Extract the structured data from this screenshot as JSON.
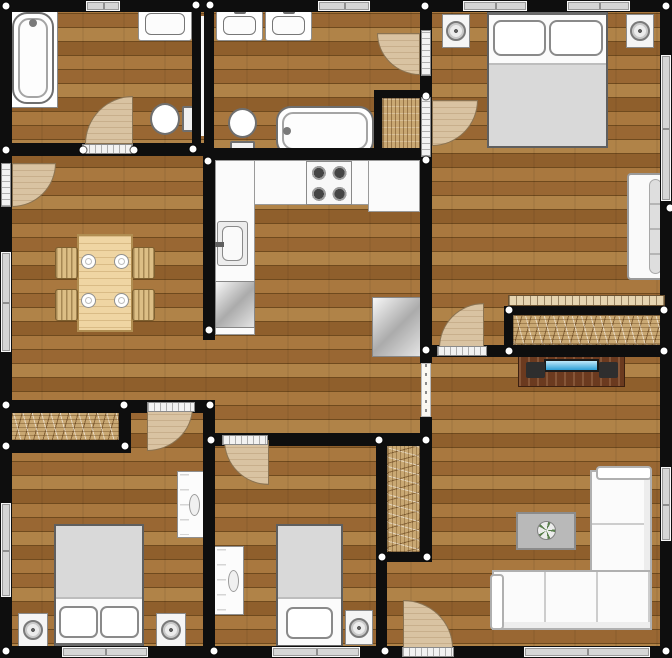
{
  "plan": {
    "width": 672,
    "height": 658
  },
  "colors": {
    "wall": "#0e0e0e",
    "floor_light": "#b08348",
    "floor_mid": "#996733",
    "floor_dark": "#8f5f2c",
    "door_leaf": "#d9c3a2",
    "window_glass": "#d6d6d6",
    "tv_screen": "#2e9fd6",
    "closet_hatch": "#c9a873",
    "bedding_gray": "#d9d9d9"
  },
  "walls": [
    {
      "name": "wall-exterior-top",
      "r": [
        0,
        0,
        672,
        12
      ]
    },
    {
      "name": "wall-exterior-left",
      "r": [
        0,
        0,
        12,
        658
      ]
    },
    {
      "name": "wall-exterior-right",
      "r": [
        660,
        0,
        12,
        658
      ]
    },
    {
      "name": "wall-exterior-bottom",
      "r": [
        0,
        646,
        672,
        12
      ]
    },
    {
      "name": "wall-bathroom1-south",
      "r": [
        0,
        143,
        212,
        13
      ]
    },
    {
      "name": "wall-bathrooms-divider-west",
      "r": [
        192,
        8,
        9,
        140
      ]
    },
    {
      "name": "wall-bathrooms-divider-east",
      "r": [
        204,
        8,
        10,
        140
      ]
    },
    {
      "name": "wall-kitchen-west",
      "r": [
        203,
        148,
        12,
        192
      ]
    },
    {
      "name": "wall-kitchen-north",
      "r": [
        203,
        148,
        229,
        12
      ]
    },
    {
      "name": "wall-spine-upper",
      "r": [
        420,
        12,
        12,
        351
      ]
    },
    {
      "name": "wall-spine-lower",
      "r": [
        420,
        417,
        12,
        145
      ]
    },
    {
      "name": "wall-ensuite-closet-west",
      "r": [
        374,
        90,
        8,
        66
      ]
    },
    {
      "name": "wall-ensuite-closet-north",
      "r": [
        374,
        90,
        56,
        8
      ]
    },
    {
      "name": "wall-master-south",
      "r": [
        432,
        345,
        240,
        12
      ]
    },
    {
      "name": "wall-master-closet-north",
      "r": [
        504,
        306,
        168,
        9
      ]
    },
    {
      "name": "wall-master-closet-west",
      "r": [
        504,
        306,
        9,
        51
      ]
    },
    {
      "name": "wall-dining-south",
      "r": [
        0,
        400,
        215,
        13
      ]
    },
    {
      "name": "wall-bedroom1-closet-south",
      "r": [
        0,
        440,
        131,
        13
      ]
    },
    {
      "name": "wall-bedroom1-closet-east",
      "r": [
        119,
        400,
        12,
        53
      ]
    },
    {
      "name": "wall-bedroom1-bedroom2",
      "r": [
        203,
        400,
        12,
        258
      ]
    },
    {
      "name": "wall-bedroom2-north",
      "r": [
        203,
        433,
        229,
        13
      ]
    },
    {
      "name": "wall-bedroom2-east",
      "r": [
        376,
        433,
        11,
        225
      ]
    },
    {
      "name": "wall-hall-closet-south",
      "r": [
        376,
        552,
        56,
        10
      ]
    }
  ],
  "wall_gaps": [
    {
      "name": "plumbing-wall-gap",
      "r": [
        201,
        16,
        3,
        120
      ]
    }
  ],
  "windows": [
    {
      "name": "window-bathroom1-top",
      "r": [
        86,
        1,
        34,
        10
      ]
    },
    {
      "name": "window-ensuite-top",
      "r": [
        318,
        1,
        52,
        10
      ]
    },
    {
      "name": "window-master-top-left",
      "r": [
        463,
        1,
        64,
        10
      ]
    },
    {
      "name": "window-master-top-right",
      "r": [
        567,
        1,
        63,
        10
      ]
    },
    {
      "name": "window-dining-left",
      "r": [
        1,
        252,
        10,
        100
      ]
    },
    {
      "name": "window-bedroom1-left",
      "r": [
        1,
        503,
        10,
        94
      ]
    },
    {
      "name": "window-master-right",
      "r": [
        661,
        55,
        10,
        146
      ]
    },
    {
      "name": "window-living-right",
      "r": [
        661,
        467,
        10,
        74
      ]
    },
    {
      "name": "window-bedroom1-bottom",
      "r": [
        62,
        647,
        86,
        10
      ]
    },
    {
      "name": "window-bedroom2-bottom",
      "r": [
        272,
        647,
        88,
        10
      ]
    },
    {
      "name": "window-living-bottom",
      "r": [
        524,
        647,
        126,
        10
      ]
    }
  ],
  "thresholds": [
    {
      "name": "threshold-bathroom1",
      "r": [
        82,
        144,
        51,
        10
      ]
    },
    {
      "name": "threshold-entrance",
      "r": [
        1,
        163,
        10,
        44
      ]
    },
    {
      "name": "threshold-ensuite",
      "r": [
        421,
        30,
        10,
        46
      ]
    },
    {
      "name": "threshold-master-entry",
      "r": [
        421,
        97,
        10,
        60
      ]
    },
    {
      "name": "threshold-bedroom1",
      "r": [
        147,
        402,
        48,
        10
      ]
    },
    {
      "name": "threshold-bedroom2",
      "r": [
        222,
        435,
        46,
        10
      ]
    },
    {
      "name": "threshold-master-south",
      "r": [
        437,
        346,
        50,
        10
      ]
    },
    {
      "name": "threshold-exterior-living",
      "r": [
        402,
        647,
        52,
        10
      ]
    }
  ],
  "passages": [
    {
      "name": "passage-kitchen-living",
      "r": [
        421,
        363,
        10,
        54
      ]
    }
  ],
  "sliders": [
    {
      "name": "sliding-door-master-closet",
      "r": [
        508,
        295,
        157,
        11
      ]
    }
  ],
  "doors": [
    {
      "name": "door-bathroom1",
      "r": [
        85,
        96,
        48,
        48
      ],
      "round": "tl"
    },
    {
      "name": "door-entrance",
      "r": [
        12,
        163,
        44,
        44
      ],
      "round": "br"
    },
    {
      "name": "door-ensuite",
      "r": [
        377,
        33,
        43,
        42
      ],
      "round": "bl"
    },
    {
      "name": "door-master-entry",
      "r": [
        432,
        100,
        46,
        46
      ],
      "round": "br"
    },
    {
      "name": "door-bedroom1",
      "r": [
        147,
        407,
        46,
        44
      ],
      "round": "br"
    },
    {
      "name": "door-bedroom2",
      "r": [
        224,
        440,
        45,
        45
      ],
      "round": "bl"
    },
    {
      "name": "door-master-south",
      "r": [
        439,
        303,
        45,
        45
      ],
      "round": "tl"
    },
    {
      "name": "door-exterior-living",
      "r": [
        403,
        600,
        50,
        48
      ],
      "round": "tr"
    }
  ],
  "hatches": [
    {
      "name": "closet-ensuite",
      "r": [
        382,
        98,
        38,
        52
      ],
      "kind": "v"
    },
    {
      "name": "closet-bedroom1",
      "r": [
        10,
        412,
        109,
        29
      ],
      "kind": "hzig"
    },
    {
      "name": "closet-master",
      "r": [
        513,
        315,
        152,
        30
      ],
      "kind": "hzig"
    },
    {
      "name": "closet-hall",
      "r": [
        387,
        443,
        33,
        109
      ],
      "kind": "vzig"
    }
  ],
  "furniture": [
    {
      "name": "bathtub-platform",
      "type": "platform",
      "r": [
        8,
        8,
        50,
        100
      ]
    },
    {
      "name": "bathtub-bathroom1",
      "type": "bathtub-v",
      "r": [
        12,
        12,
        42,
        92
      ]
    },
    {
      "name": "sink-bathroom1",
      "type": "sink",
      "r": [
        138,
        7,
        54,
        34
      ]
    },
    {
      "name": "toilet-bathroom1",
      "type": "toilet-r",
      "r": [
        150,
        101,
        44,
        36
      ]
    },
    {
      "name": "sink-ensuite-left",
      "type": "sink",
      "r": [
        216,
        10,
        47,
        31
      ]
    },
    {
      "name": "sink-ensuite-right",
      "type": "sink",
      "r": [
        265,
        10,
        47,
        31
      ]
    },
    {
      "name": "toilet-ensuite",
      "type": "toilet-d",
      "r": [
        226,
        108,
        34,
        46
      ]
    },
    {
      "name": "bathtub-ensuite",
      "type": "bathtub-h",
      "r": [
        276,
        106,
        98,
        50
      ]
    },
    {
      "name": "kitchen-counter-top",
      "type": "counter",
      "r": [
        215,
        160,
        205,
        45
      ]
    },
    {
      "name": "kitchen-counter-left",
      "type": "counter",
      "r": [
        215,
        160,
        40,
        175
      ]
    },
    {
      "name": "kitchen-counter-right",
      "type": "counter",
      "r": [
        368,
        160,
        52,
        52
      ]
    },
    {
      "name": "kitchen-stove",
      "type": "stove",
      "r": [
        306,
        161,
        46,
        44
      ]
    },
    {
      "name": "kitchen-sink",
      "type": "ksink",
      "r": [
        217,
        221,
        31,
        45
      ]
    },
    {
      "name": "kitchen-dishwasher",
      "type": "appliance",
      "r": [
        215,
        281,
        40,
        47
      ]
    },
    {
      "name": "kitchen-fridge",
      "type": "appliance",
      "r": [
        372,
        297,
        49,
        60
      ]
    },
    {
      "name": "dining-table",
      "type": "table",
      "r": [
        77,
        234,
        56,
        98
      ]
    },
    {
      "name": "dining-chair-top-left",
      "type": "chair",
      "r": [
        55,
        247,
        23,
        32
      ]
    },
    {
      "name": "dining-chair-bottom-left",
      "type": "chair",
      "r": [
        55,
        289,
        23,
        32
      ]
    },
    {
      "name": "dining-chair-top-right",
      "type": "chair",
      "r": [
        132,
        247,
        23,
        32
      ]
    },
    {
      "name": "dining-chair-bottom-right",
      "type": "chair",
      "r": [
        132,
        289,
        23,
        32
      ]
    },
    {
      "name": "plate-top-left",
      "type": "plate",
      "r": [
        81,
        254,
        15,
        15
      ]
    },
    {
      "name": "plate-top-right",
      "type": "plate",
      "r": [
        114,
        254,
        15,
        15
      ]
    },
    {
      "name": "plate-bottom-left",
      "type": "plate",
      "r": [
        81,
        293,
        15,
        15
      ]
    },
    {
      "name": "plate-bottom-right",
      "type": "plate",
      "r": [
        114,
        293,
        15,
        15
      ]
    },
    {
      "name": "master-bed",
      "type": "bed-d",
      "r": [
        487,
        10,
        121,
        138
      ]
    },
    {
      "name": "master-nightstand-left",
      "type": "nightstand",
      "r": [
        442,
        14,
        28,
        34
      ]
    },
    {
      "name": "master-nightstand-right",
      "type": "nightstand",
      "r": [
        626,
        14,
        28,
        34
      ]
    },
    {
      "name": "master-sofa",
      "type": "sofa-side",
      "r": [
        627,
        173,
        39,
        107
      ]
    },
    {
      "name": "tv-stand",
      "type": "tvstand",
      "r": [
        518,
        354,
        107,
        33
      ]
    },
    {
      "name": "bedroom1-bed",
      "type": "bed-up",
      "r": [
        54,
        524,
        90,
        124
      ]
    },
    {
      "name": "bedroom1-nightstand-left",
      "type": "nightstand",
      "r": [
        18,
        613,
        30,
        34
      ]
    },
    {
      "name": "bedroom1-nightstand-right",
      "type": "nightstand",
      "r": [
        156,
        613,
        30,
        34
      ]
    },
    {
      "name": "bedroom1-dresser",
      "type": "dresser",
      "r": [
        177,
        471,
        28,
        67
      ]
    },
    {
      "name": "bedroom2-bed",
      "type": "bed-single",
      "r": [
        276,
        524,
        67,
        126
      ]
    },
    {
      "name": "bedroom2-nightstand",
      "type": "nightstand",
      "r": [
        345,
        610,
        28,
        35
      ]
    },
    {
      "name": "bedroom2-dresser",
      "type": "dresser",
      "r": [
        214,
        546,
        30,
        69
      ]
    },
    {
      "name": "living-sofa-chaise",
      "type": "sofa-piece-v",
      "r": [
        590,
        470,
        62,
        160
      ]
    },
    {
      "name": "living-sofa-seat",
      "type": "sofa-piece-h",
      "r": [
        492,
        570,
        160,
        60
      ]
    },
    {
      "name": "living-sofa-arm-top",
      "type": "sofa-arm",
      "r": [
        596,
        466,
        56,
        14
      ]
    },
    {
      "name": "living-sofa-arm-left",
      "type": "sofa-arm",
      "r": [
        490,
        574,
        14,
        56
      ]
    },
    {
      "name": "coffee-table",
      "type": "ctable",
      "r": [
        516,
        512,
        60,
        38
      ]
    },
    {
      "name": "plant",
      "type": "plant",
      "r": [
        537,
        521,
        19,
        19
      ]
    }
  ],
  "dots": [
    [
      6,
      6
    ],
    [
      196,
      5
    ],
    [
      210,
      5
    ],
    [
      425,
      6
    ],
    [
      666,
      6
    ],
    [
      6,
      150
    ],
    [
      83,
      150
    ],
    [
      134,
      150
    ],
    [
      193,
      149
    ],
    [
      208,
      161
    ],
    [
      670,
      208
    ],
    [
      209,
      330
    ],
    [
      210,
      405
    ],
    [
      6,
      405
    ],
    [
      124,
      405
    ],
    [
      6,
      446
    ],
    [
      125,
      446
    ],
    [
      211,
      440
    ],
    [
      379,
      440
    ],
    [
      426,
      440
    ],
    [
      426,
      96
    ],
    [
      426,
      160
    ],
    [
      426,
      350
    ],
    [
      509,
      310
    ],
    [
      664,
      310
    ],
    [
      509,
      351
    ],
    [
      664,
      351
    ],
    [
      382,
      557
    ],
    [
      427,
      557
    ],
    [
      6,
      651
    ],
    [
      214,
      651
    ],
    [
      385,
      651
    ],
    [
      666,
      651
    ]
  ]
}
